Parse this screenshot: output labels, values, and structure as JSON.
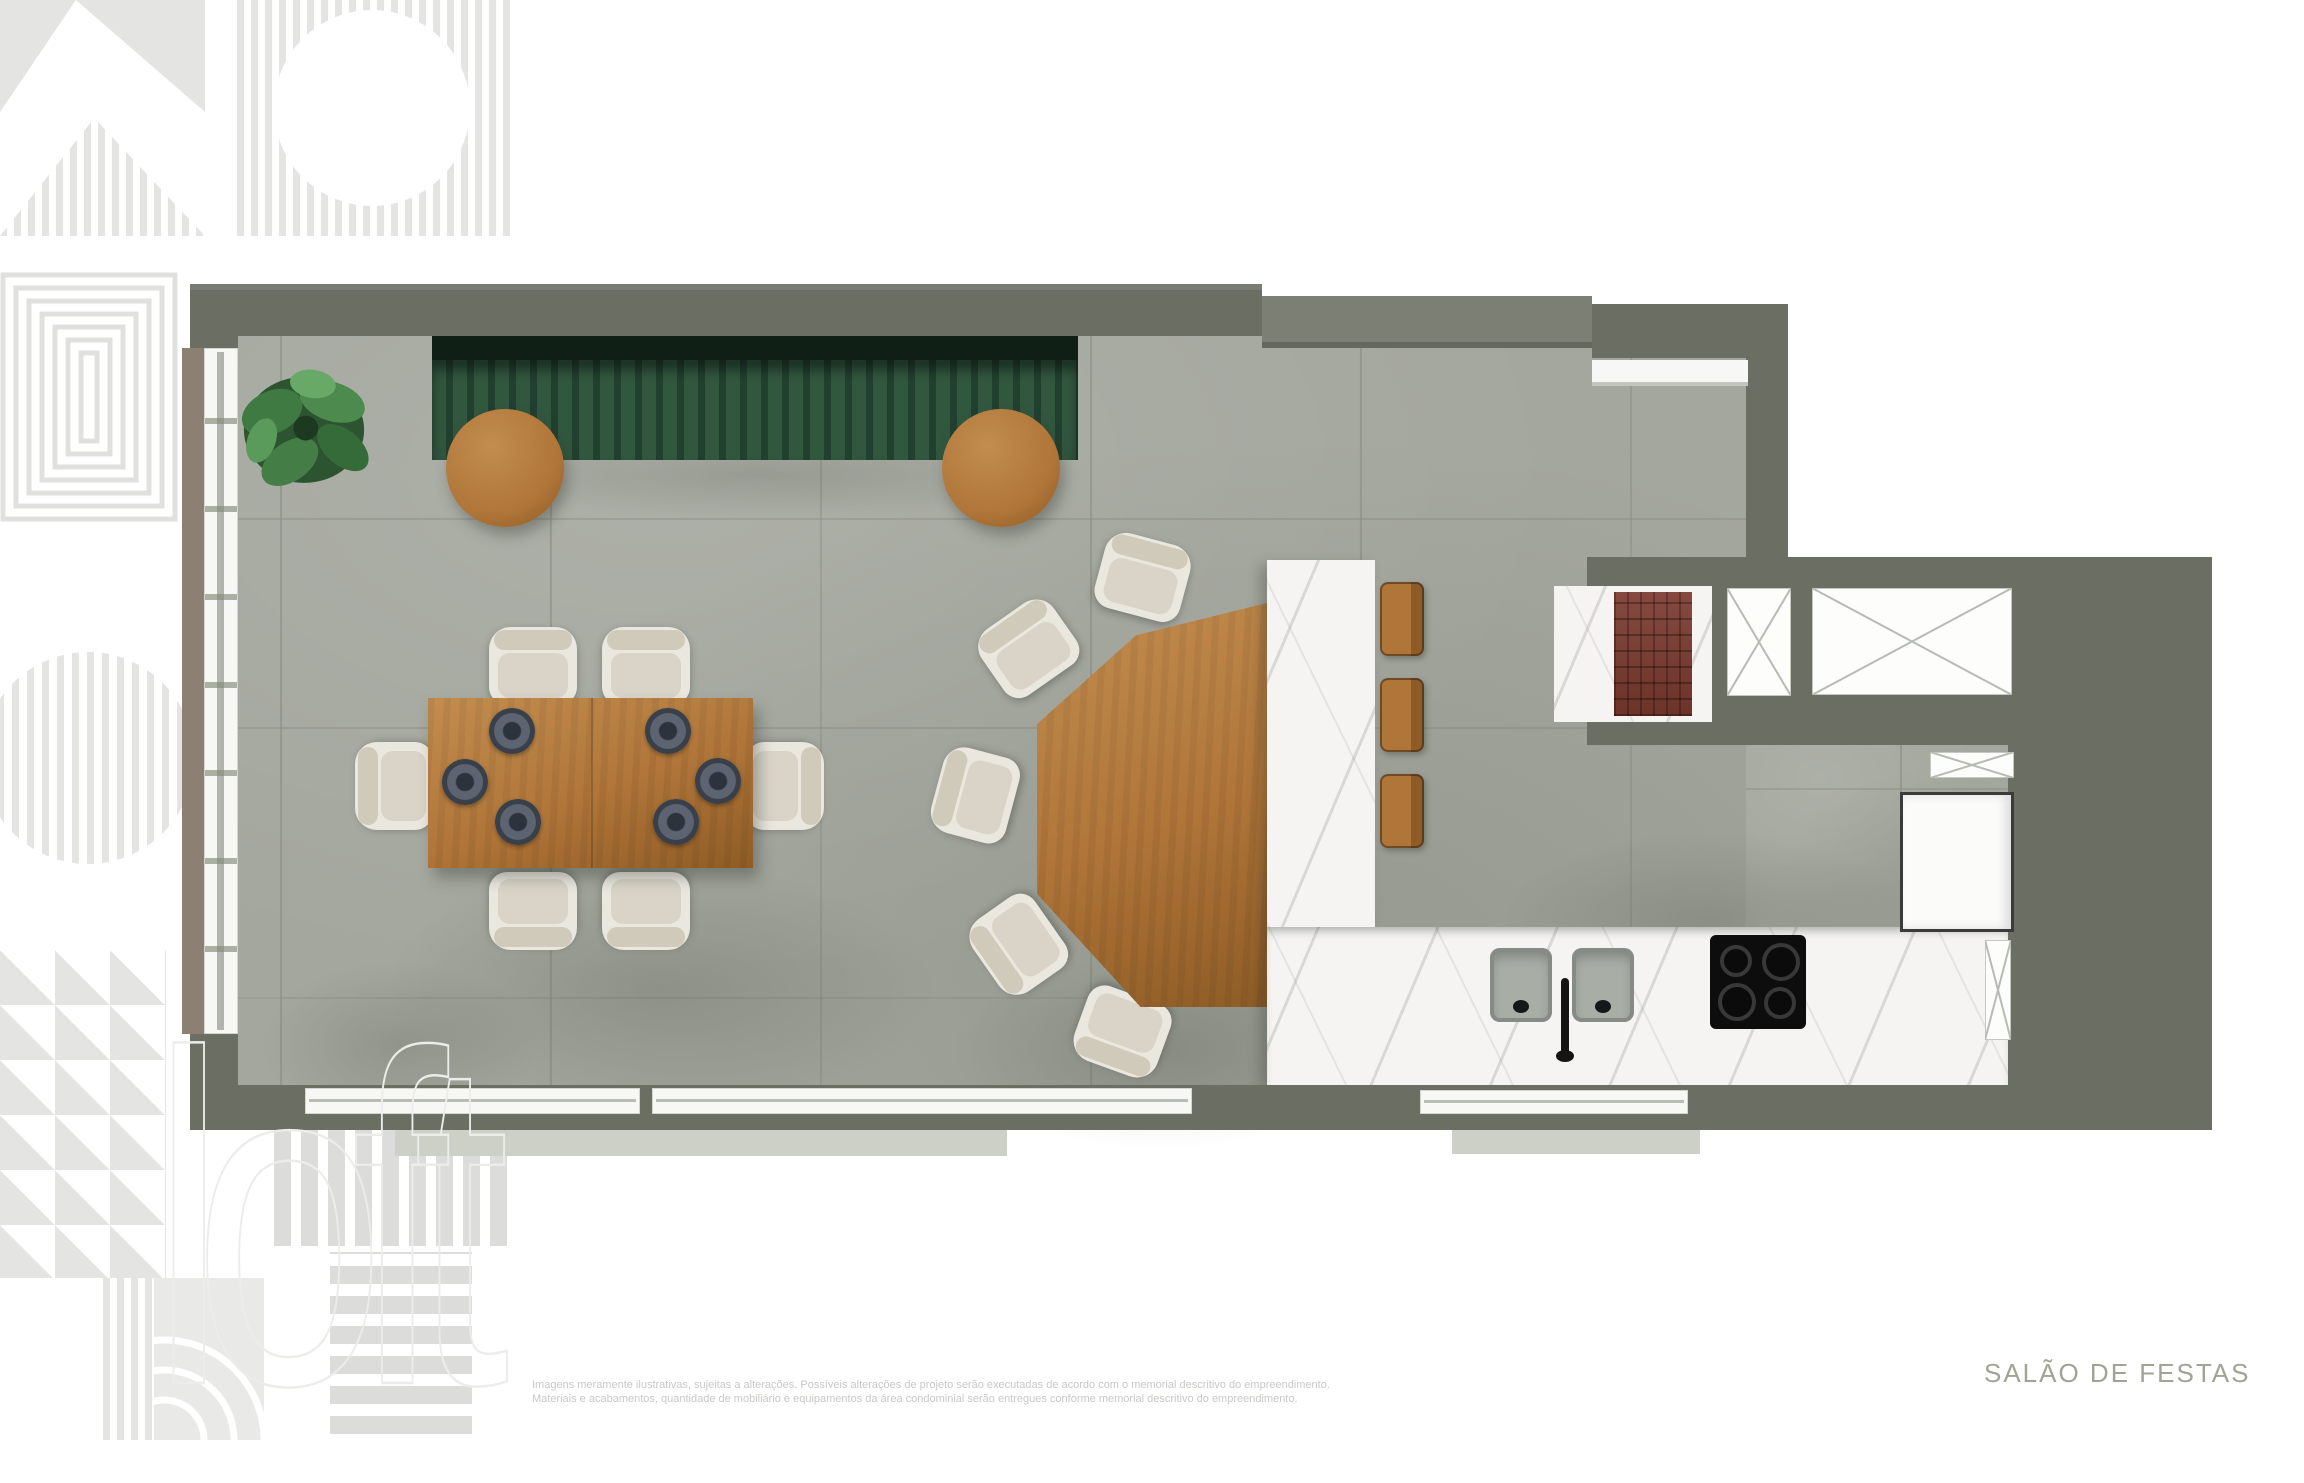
{
  "canvas": {
    "width": 2304,
    "height": 1440,
    "background": "#ffffff"
  },
  "labels": {
    "room_name": "SALÃO DE FESTAS",
    "watermark": "loft",
    "disclaimer_line1": "Imagens meramente ilustrativas, sujeitas a alterações. Possíveis alterações de projeto serão executadas de acordo com o memorial descritivo do empreendimento.",
    "disclaimer_line2": "Materiais e acabamentos, quantidade de mobiliário e equipamentos da área condominial serão entregues conforme memorial descritivo do empreendimento."
  },
  "palette": {
    "wall": "#6a6e63",
    "wall_light": "#7b7f74",
    "floor": "#a4a79e",
    "bench": "#22402f",
    "bench_hi": "#32573f",
    "bench_dark": "#101f16",
    "wood": "#b07539",
    "wood_hi": "#c28d4f",
    "wood_dk": "#8e5c26",
    "marble": "#f5f4f2",
    "brick": "#7b3a2f",
    "chair": "#eae7df",
    "chair_md": "#d9d4c7",
    "chair_dk": "#cfcaba",
    "pattern": "#e4e4e2",
    "pattern2": "#dcdcda",
    "label": "#a2a295",
    "disclaimer": "#c9c8c6"
  },
  "plan": {
    "type": "floor-plan-top-view",
    "room": "Salão de Festas (party room with kitchen)",
    "elements": [
      "green-slat-bench",
      "monstera-plant",
      "round-side-table",
      "round-side-table",
      "dining-table-6-seats",
      "dinner-plates",
      "fan-shaped-table",
      "upholstered-chairs",
      "marble-island",
      "bar-stools",
      "double-sink",
      "faucet",
      "cooktop-4-burners",
      "grill-churrasqueira",
      "ventilation-shaft",
      "refrigerator",
      "sliding-glass-doors"
    ]
  }
}
